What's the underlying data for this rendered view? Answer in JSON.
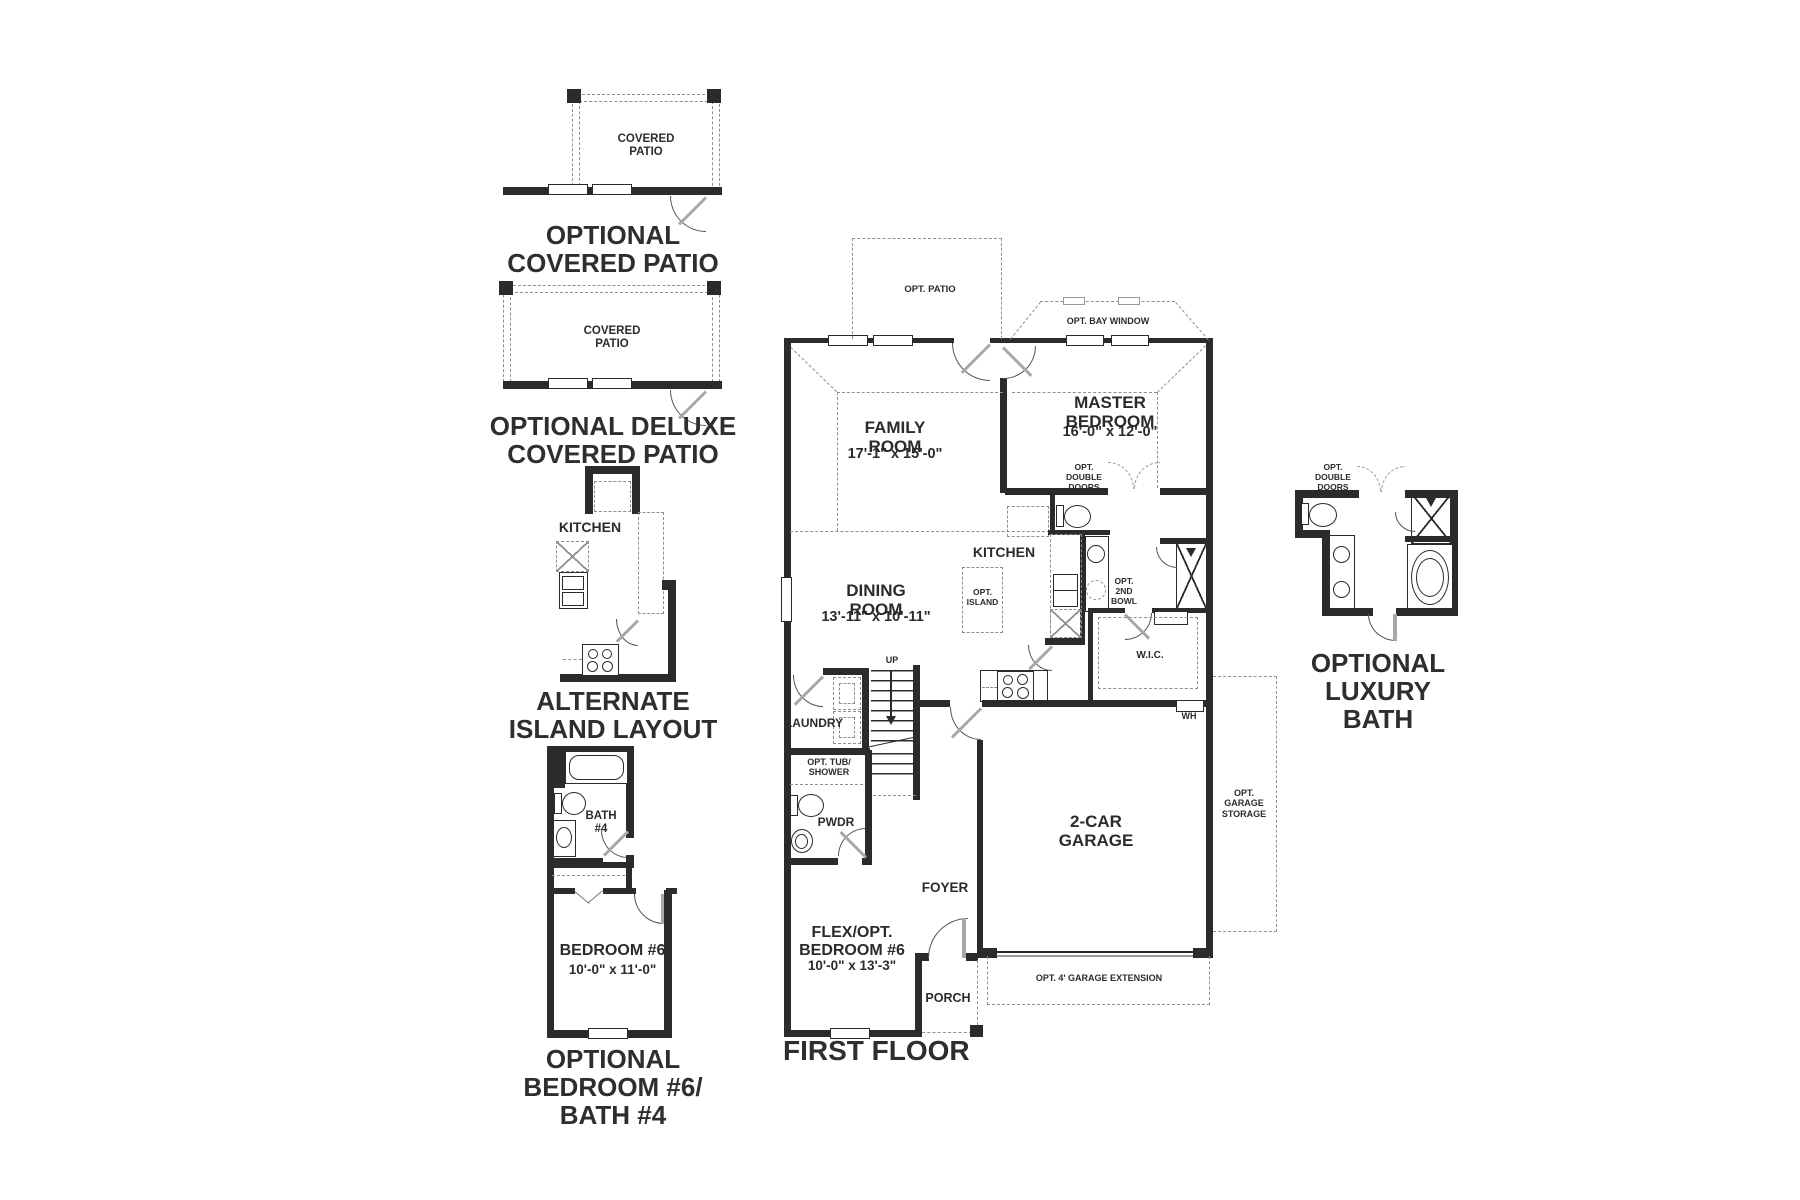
{
  "palette": {
    "ink": "#2b2b2b",
    "dash_gray": "#8f8f8f",
    "door_leaf": "#a8a8a8",
    "background": "#ffffff"
  },
  "insets": {
    "covered_patio": {
      "room": "COVERED\nPATIO",
      "caption": "OPTIONAL\nCOVERED PATIO"
    },
    "deluxe_patio": {
      "room": "COVERED\nPATIO",
      "caption": "OPTIONAL DELUXE\nCOVERED PATIO"
    },
    "island": {
      "room": "KITCHEN",
      "caption": "ALTERNATE\nISLAND LAYOUT"
    },
    "bed6": {
      "bath": "BATH\n#4",
      "bedroom": "BEDROOM #6",
      "bedroom_dims": "10'-0\" x 11'-0\"",
      "caption": "OPTIONAL\nBEDROOM #6/\nBATH #4"
    }
  },
  "main": {
    "caption": "FIRST FLOOR",
    "rooms": {
      "family": {
        "name": "FAMILY\nROOM",
        "dims": "17'-1\" x 15'-0\""
      },
      "master": {
        "name": "MASTER\nBEDROOM",
        "dims": "16'-0\" x 12'-0\""
      },
      "dining": {
        "name": "DINING\nROOM",
        "dims": "13'-11\" x 10'-11\""
      },
      "kitchen": {
        "name": "KITCHEN"
      },
      "laundry": {
        "name": "LAUNDRY"
      },
      "pwdr": {
        "name": "PWDR"
      },
      "foyer": {
        "name": "FOYER"
      },
      "flex": {
        "name": "FLEX/OPT.\nBEDROOM #6",
        "dims": "10'-0\" x 13'-3\""
      },
      "porch": {
        "name": "PORCH"
      },
      "garage": {
        "name": "2-CAR\nGARAGE"
      },
      "wic": {
        "name": "W.I.C."
      }
    },
    "annotations": {
      "opt_patio": "OPT. PATIO",
      "opt_bay": "OPT. BAY WINDOW",
      "opt_dbl_doors": "OPT.\nDOUBLE\nDOORS",
      "opt_island": "OPT.\nISLAND",
      "opt_2nd_bowl": "OPT.\n2ND\nBOWL",
      "opt_tub": "OPT. TUB/\nSHOWER",
      "up": "UP",
      "wh": "WH",
      "opt_storage": "OPT.\nGARAGE\nSTORAGE",
      "opt_ext": "OPT. 4' GARAGE EXTENSION"
    }
  },
  "luxury": {
    "opt_dbl_doors": "OPT.\nDOUBLE\nDOORS",
    "caption": "OPTIONAL\nLUXURY BATH"
  }
}
